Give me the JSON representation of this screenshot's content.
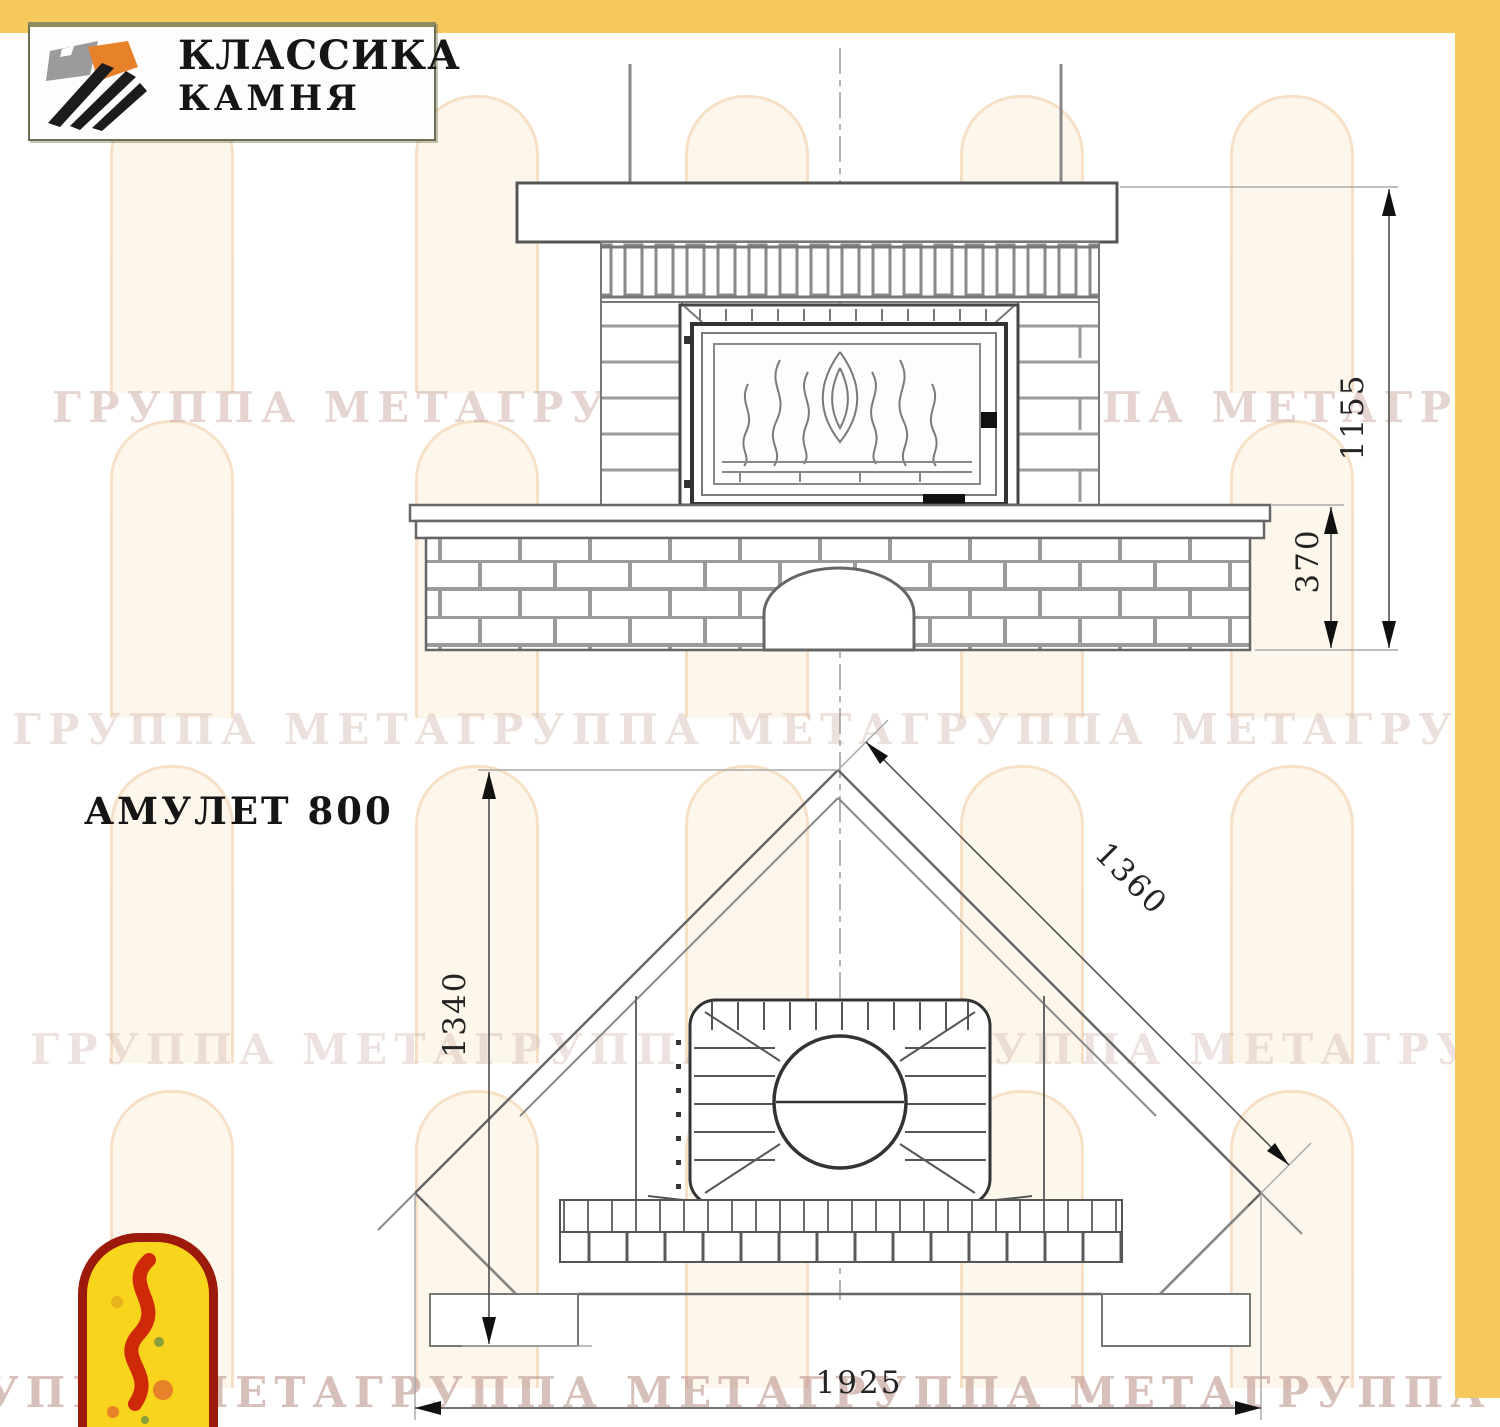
{
  "brand": {
    "line1": "КЛАССИКА",
    "line2": "КАМНЯ"
  },
  "model": {
    "title": "АМУЛЕТ 800"
  },
  "dimensions": {
    "front_total_height": "1155",
    "plinth_height": "370",
    "plan_depth": "1340",
    "plan_diagonal": "1360",
    "plan_width": "1925"
  },
  "watermark": {
    "row_text": "ГРУППА МЕТАГРУППА МЕТАГРУППА МЕТАГРУППА МЕТАГРУППА МЕТА"
  },
  "colors": {
    "accent_yellow": "#f5c95c",
    "logo_stone_gray": "#9b9b9b",
    "logo_stone_orange": "#e8822a",
    "logo_stone_black": "#1c1c1c",
    "meta_border_red": "#9c1a0a",
    "meta_fill_yellow": "#f8d41c",
    "meta_figure_red": "#cf2a08",
    "drawing_line_gray": "#8a8a8a",
    "dimension_text": "#242424"
  }
}
